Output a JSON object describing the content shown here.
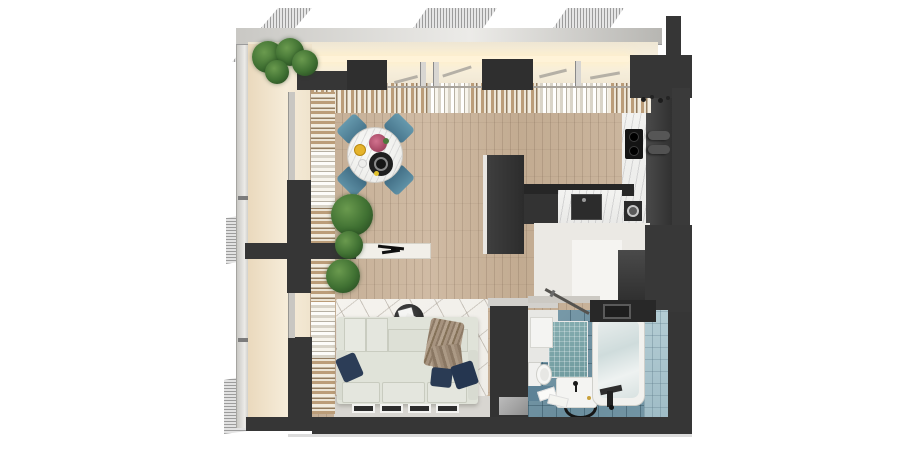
{
  "scene": {
    "type": "3d-floor-plan-render",
    "view": "top-down",
    "rooms": [
      {
        "name": "balcony",
        "floor_color": "#f2e7d2",
        "features": [
          "glass-railing",
          "corner-plants",
          "striped-awnings"
        ]
      },
      {
        "name": "living-dining-room",
        "floor_color": "#c9b49c",
        "furniture": [
          "round-marble-dining-table",
          "teal-chairs-x4",
          "white-sofa",
          "navy-pillows-x3",
          "taupe-throw-blanket",
          "round-coffee-table",
          "geometric-rug",
          "white-console-table",
          "potted-plants-x3",
          "leaning-picture-frames-x4",
          "curtains"
        ]
      },
      {
        "name": "kitchen",
        "cabinet_color": "#333333",
        "counter_color": "#f0efed",
        "appliances": [
          "black-cooktop-2-burners",
          "tall-fridge-unit",
          "dark-sink",
          "round-basin",
          "peninsula-counter",
          "bar-cabinet"
        ]
      },
      {
        "name": "hallway",
        "features": [
          "wardrobe",
          "top-load-washing-machine",
          "open-sliding-door"
        ]
      },
      {
        "name": "bathroom",
        "floor_color": "#7093a3",
        "fixtures": [
          "bathtub",
          "vanity-sink",
          "toilet",
          "teal-mosaic-panel",
          "wall-cabinet",
          "towels",
          "round-black-mat",
          "hand-shower"
        ]
      }
    ],
    "palette": {
      "background": "#ffffff",
      "walls": "#363636",
      "wood_floor": "#c9b49c",
      "balcony_floor": "#f2e7d2",
      "roof_band": "#f9f2e2",
      "curtain_tan": "#bb9d79",
      "curtain_white": "#f2ecdf",
      "chair_teal": "#5b8ea6",
      "sofa": "#e0e3d9",
      "pillow_navy": "#2c3d57",
      "throw_taupe": "#a6937f",
      "bath_tile": "#7093a3",
      "mosaic_teal": "#7ba6a9",
      "marble": "#f0efed",
      "plant_green": "#3f7032"
    }
  }
}
